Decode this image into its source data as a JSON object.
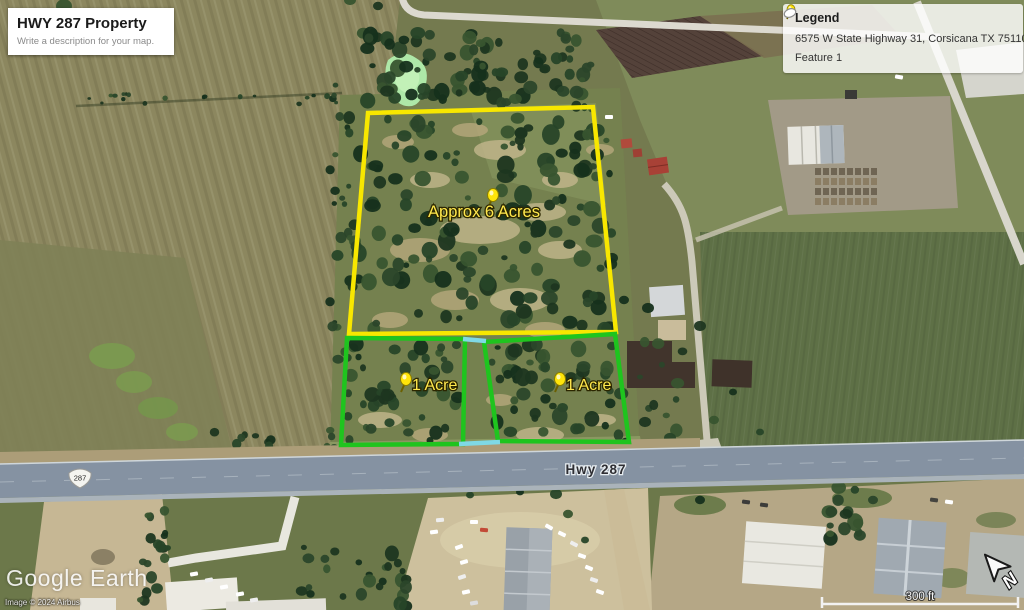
{
  "title_card": {
    "title": "HWY 287 Property",
    "subtitle": "Write a description for your map."
  },
  "legend": {
    "heading": "Legend",
    "items": [
      {
        "icon": "pushpin-icon",
        "label": "6575 W State Highway 31, Corsicana TX 75110"
      },
      {
        "icon": "polygon-outline-icon",
        "label": "Feature 1"
      }
    ]
  },
  "map": {
    "parcels": [
      {
        "name": "six-acre-parcel",
        "label": "Approx 6 Acres",
        "outline_color": "#f8e700"
      },
      {
        "name": "one-acre-parcel-west",
        "label": "1 Acre",
        "outline_color": "#1fc41e"
      },
      {
        "name": "one-acre-parcel-east",
        "label": "1 Acre",
        "outline_color": "#1fc41e"
      }
    ],
    "feature1_color": "#7fd9e6",
    "pin_color": "#ffe50a",
    "highway": {
      "shield": "287",
      "label": "Hwy 287"
    }
  },
  "scale_bar": {
    "label": "300 ft"
  },
  "compass": {
    "north_label": "N"
  },
  "attribution": {
    "logo": "Google Earth",
    "copyright": "Image © 2024 Airbus"
  }
}
